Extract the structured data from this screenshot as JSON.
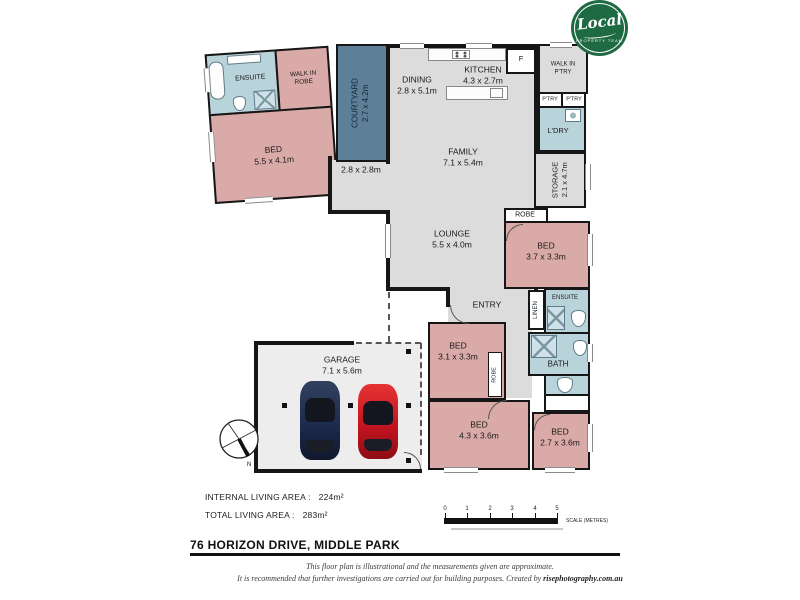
{
  "logo": {
    "brand": "Local",
    "tagline": "PROPERTY TEAM",
    "color": "#1e6a42"
  },
  "rooms": {
    "master_ensuite": {
      "name": "ENSUITE"
    },
    "walk_in_robe": {
      "name": "WALK IN ROBE"
    },
    "master_bed": {
      "name": "BED",
      "dims": "5.5 x 4.1m"
    },
    "courtyard": {
      "name": "COURTYARD",
      "dims": "2.7 x 4.2m"
    },
    "dining": {
      "name": "DINING",
      "dims": "2.8 x 5.1m"
    },
    "kitchen": {
      "name": "KITCHEN",
      "dims": "4.3 x 2.7m"
    },
    "fridge": {
      "name": "F"
    },
    "walk_in_pantry": {
      "name": "WALK IN P'TRY"
    },
    "pantry1": {
      "name": "P'TRY"
    },
    "pantry2": {
      "name": "P'TRY"
    },
    "laundry": {
      "name": "L'DRY"
    },
    "family": {
      "name": "FAMILY",
      "dims": "7.1 x 5.4m"
    },
    "storage": {
      "name": "STORAGE",
      "dims": "2.1 x 4.7m"
    },
    "hall": {
      "dims": "2.8 x 2.8m"
    },
    "robe_bed2": {
      "name": "ROBE"
    },
    "bed2": {
      "name": "BED",
      "dims": "3.7 x 3.3m"
    },
    "lounge": {
      "name": "LOUNGE",
      "dims": "5.5 x 4.0m"
    },
    "entry": {
      "name": "ENTRY"
    },
    "linen": {
      "name": "LINEN"
    },
    "ensuite2": {
      "name": "ENSUITE"
    },
    "bath": {
      "name": "BATH"
    },
    "bed3": {
      "name": "BED",
      "dims": "3.1 x 3.3m"
    },
    "robe_bed3": {
      "name": "ROBE"
    },
    "garage": {
      "name": "GARAGE",
      "dims": "7.1 x 5.6m"
    },
    "bed4": {
      "name": "BED",
      "dims": "4.3 x 3.6m"
    },
    "bed5": {
      "name": "BED",
      "dims": "2.7 x 3.6m"
    }
  },
  "areas": {
    "internal_label": "INTERNAL LIVING AREA :",
    "internal_value": "224m²",
    "total_label": "TOTAL LIVING AREA :",
    "total_value": "283m²"
  },
  "address": "76 HORIZON DRIVE, MIDDLE PARK",
  "scale": {
    "ticks": [
      "0",
      "1",
      "2",
      "3",
      "4",
      "5"
    ],
    "label": "SCALE (METRES)"
  },
  "compass": {
    "north": "N"
  },
  "footer": {
    "line1": "This floor plan is illustrational and the measurements given are approximate.",
    "line2": "It is recommended that further investigations are carried out for building purposes. Created by ",
    "credit": "risephotography.com.au"
  },
  "colors": {
    "wall": "#161616",
    "bedroom_fill": "#d9aaa8",
    "wet_area_fill": "#b9d3db",
    "courtyard_fill": "#5d8098",
    "living_fill": "#dcdcdc",
    "garage_fill": "#ededed",
    "logo_green": "#1e6a42",
    "car_red": "#c41420",
    "car_navy": "#1d2b4e"
  }
}
